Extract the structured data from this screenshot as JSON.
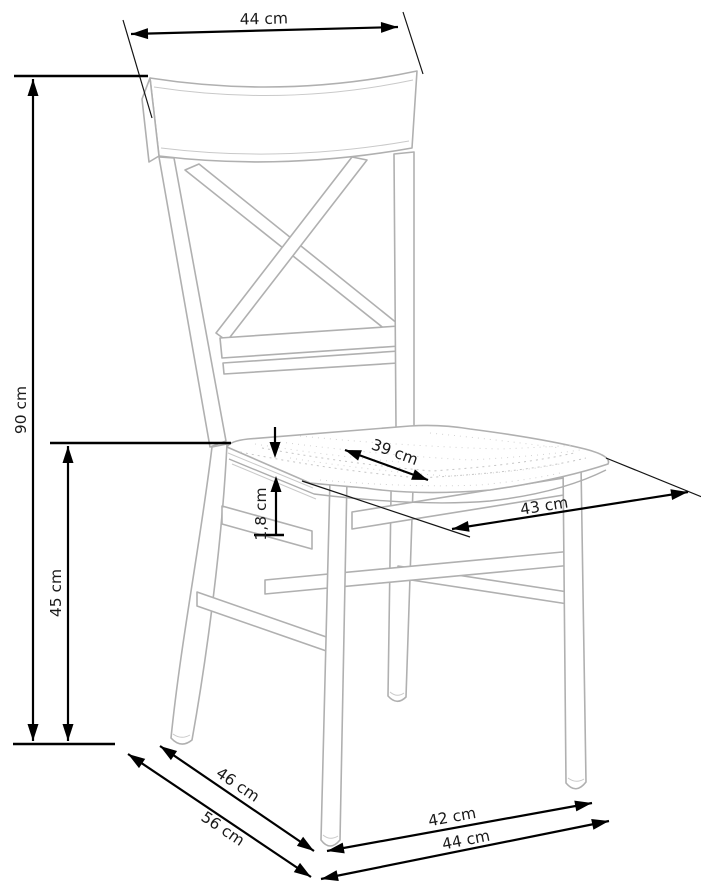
{
  "diagram": {
    "title": "Chair dimension drawing",
    "subject": "wooden dining chair with X-cross backrest",
    "unit": "cm",
    "colors": {
      "background": "#ffffff",
      "dimension_lines": "#000000",
      "label_text": "#1a1a1a",
      "sketch_lines": "#b0b0b0"
    },
    "labels": {
      "back_width": "44 cm",
      "total_height": "90 cm",
      "seat_height": "45 cm",
      "seat_depth": "39 cm",
      "seat_front_width": "43 cm",
      "seat_thickness": "1,8 cm",
      "footprint_depth_inner": "46 cm",
      "footprint_depth_outer": "56 cm",
      "footprint_width_inner": "42 cm",
      "footprint_width_outer": "44 cm"
    }
  }
}
